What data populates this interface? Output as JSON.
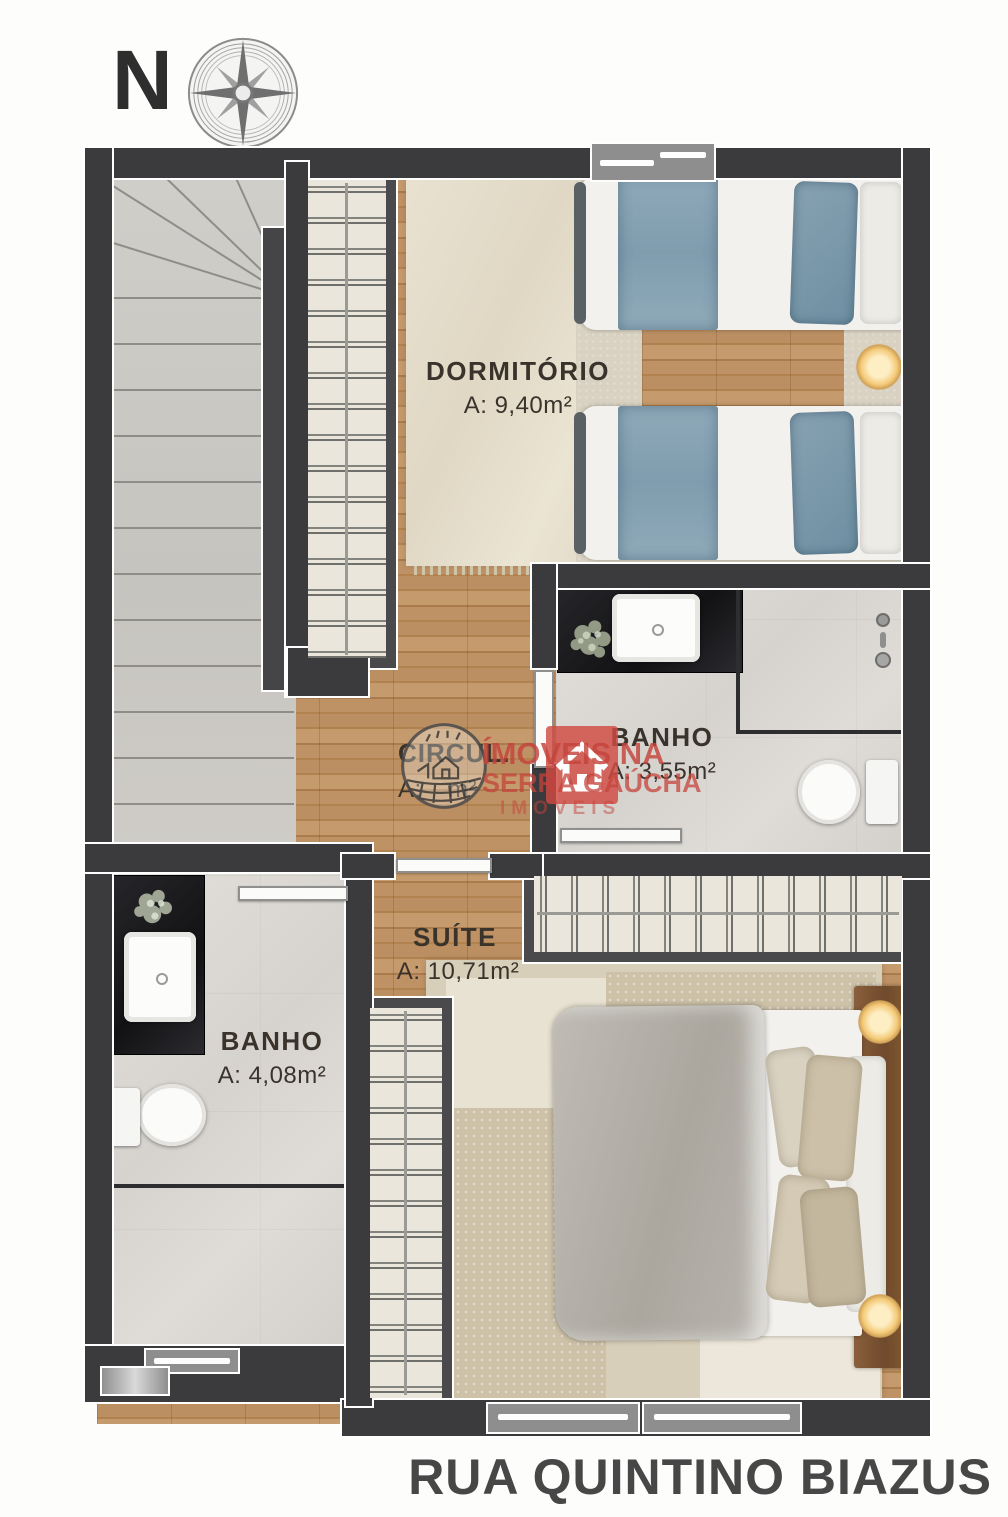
{
  "compass": {
    "north_label": "N"
  },
  "rooms": {
    "dormitorio": {
      "name": "DORMITÓRIO",
      "area": "A: 9,40m²"
    },
    "banho_superior": {
      "name": "BANHO",
      "area": "A: 3,55m²"
    },
    "circulacao": {
      "name": "CIRCUL.",
      "area_prefix": "A:",
      "area_suffix": "m²"
    },
    "suite": {
      "name": "SUÍTE",
      "area": "A: 10,71m²"
    },
    "banho_inferior": {
      "name": "BANHO",
      "area": "A: 4,08m²"
    }
  },
  "watermark": {
    "agency_line1": "ÍMOVEIS NA",
    "agency_line2": "SERRA GAÚCHA",
    "agency_line3": "IMOVEIS",
    "logo_icon": "house-icon",
    "badge_icon": "farm-circle-logo"
  },
  "street_label": "RUA QUINTINO BIAZUS",
  "colors": {
    "wall": "#3b3a3c",
    "wood_floor": "#b98e60",
    "tile_floor": "#dcd9d4",
    "accent_red": "#c5443c",
    "bed_blue": "#8aa7b8",
    "lamp_gold": "#f3c978"
  }
}
